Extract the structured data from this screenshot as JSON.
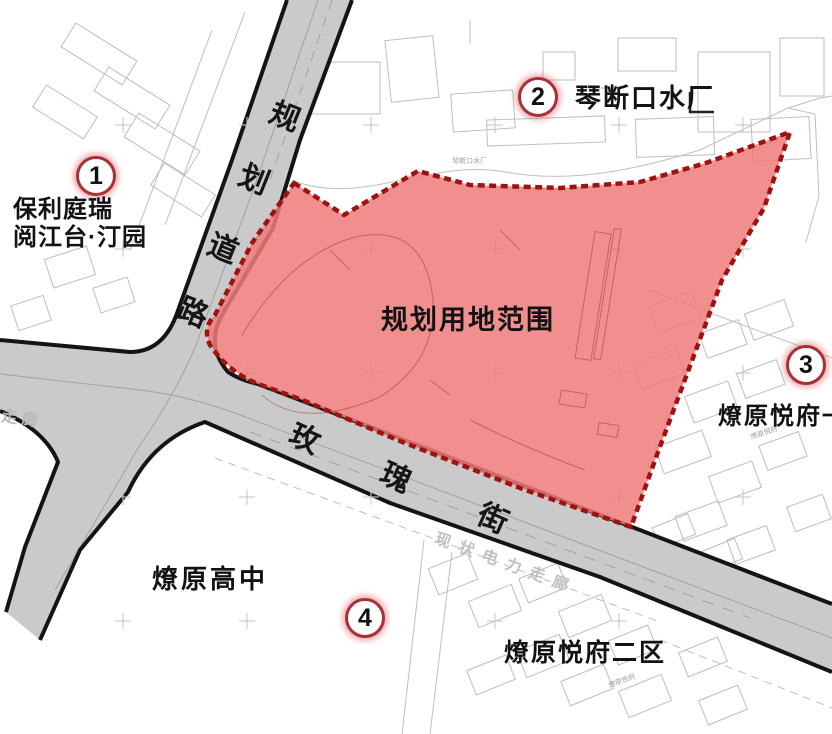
{
  "planning_area": {
    "label": "规划用地范围"
  },
  "roads": {
    "planned_road": {
      "chars": [
        "规",
        "划",
        "道",
        "路"
      ]
    },
    "rose_street": {
      "chars": [
        "玫",
        "瑰",
        "街"
      ]
    }
  },
  "markers": [
    {
      "number": "1"
    },
    {
      "number": "2"
    },
    {
      "number": "3"
    },
    {
      "number": "4"
    }
  ],
  "site_labels": {
    "poli_line1": "保利庭瑞",
    "poli_line2": "阅江台·汀园",
    "water_plant": "琴断口水厂",
    "yuefu_east": "燎原悦府一区",
    "high_school": "燎原高中",
    "yuefu_district2": "燎原悦府二区"
  },
  "small_texts": {
    "water_plant_small": "琴断口水厂",
    "yuefu_small_right": "燎原悦府",
    "yuefu_small_bottom": "燎原悦府",
    "power_corridor": "现状电力走廊",
    "corridor_partial": "走廊"
  },
  "colors": {
    "planning_area_fill": "#EE7A7A",
    "planning_area_border": "#9E1212",
    "road_fill": "#CACACA",
    "road_edge": "#141414",
    "badge_ring": "#A83038",
    "cad_line": "#B9BFC2"
  }
}
